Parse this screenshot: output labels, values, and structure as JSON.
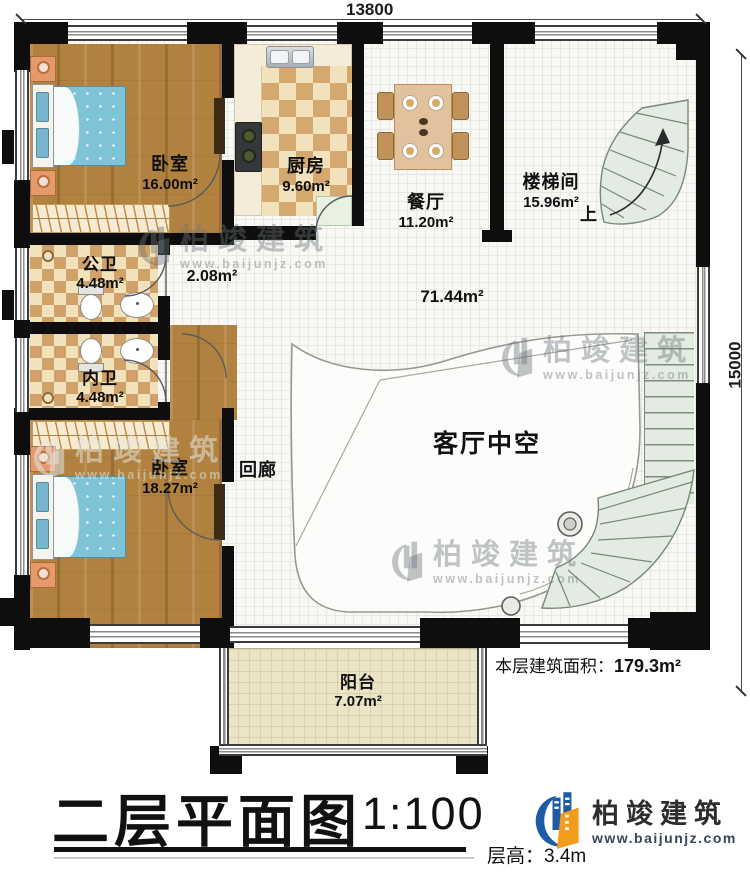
{
  "dimensions": {
    "width_label": "13800",
    "height_label": "15000"
  },
  "rooms": {
    "bedroom1": {
      "name": "卧室",
      "area": "16.00m²"
    },
    "kitchen": {
      "name": "厨房",
      "area": "9.60m²"
    },
    "dining": {
      "name": "餐厅",
      "area": "11.20m²"
    },
    "stairwell": {
      "name": "楼梯间",
      "area": "15.96m²",
      "up": "上"
    },
    "bath_public": {
      "name": "公卫",
      "area": "4.48m²"
    },
    "hall": {
      "area": "2.08m²"
    },
    "bath_inner": {
      "name": "内卫",
      "area": "4.48m²"
    },
    "bedroom2": {
      "name": "卧室",
      "area": "18.27m²"
    },
    "corridor": {
      "name": "回廊"
    },
    "void": {
      "name": "客厅中空",
      "area": "71.44m²"
    },
    "balcony": {
      "name": "阳台",
      "area": "7.07m²"
    }
  },
  "notes": {
    "floor_area_label": "本层建筑面积：",
    "floor_area_value": "179.3m²",
    "floor_height_label": "层高：",
    "floor_height_value": "3.4m"
  },
  "title": {
    "name": "二层平面图",
    "scale": "1:100"
  },
  "brand": {
    "name": "柏竣建筑",
    "url": "www.baijunjz.com"
  },
  "watermark": {
    "name": "柏竣建筑",
    "url": "www.baijunjz.com"
  },
  "colors": {
    "wall": "#0e0e0e",
    "wood_floor": "#b0813f",
    "checker_tile": "#d5a86f",
    "stair": "#e3ebe2",
    "bed": "#7ec3d6",
    "logo_blue": "#1d5ca5",
    "logo_orange": "#f29b1d"
  }
}
